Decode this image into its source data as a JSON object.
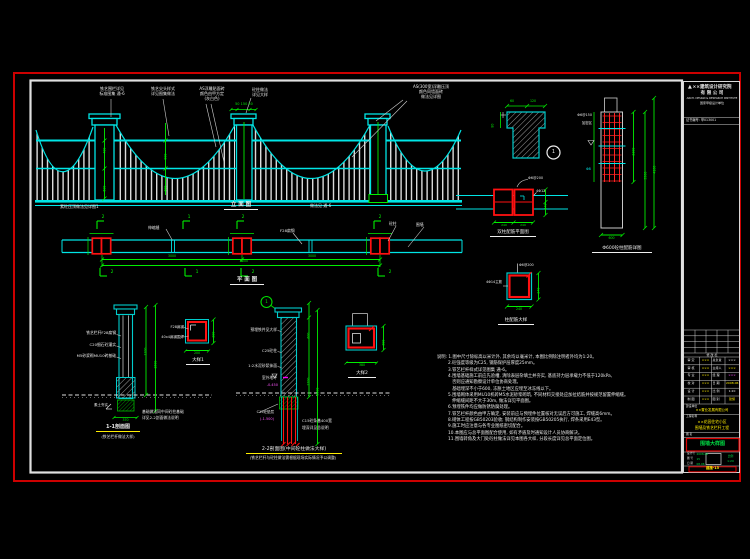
{
  "sheet": {
    "border_color": "#cc0000",
    "frame_color": "#e8e8e8"
  },
  "elevation": {
    "title": "立 面 图",
    "top_labels": [
      {
        "l1": "铁艺围栏详见",
        "l2": "标准图集 通-6"
      },
      {
        "l1": "铁艺尖头样式",
        "l2": "详见图集做法"
      },
      {
        "l1": "AS浮雕贴面砖",
        "l2": "颜色由甲方定",
        "l3": "(灰白色)"
      },
      {
        "l1": "砼柱做法",
        "l2": "详见大样"
      },
      {
        "l1": "AS(300宽)浮雕压顶",
        "l2": "颜色同墙面砖",
        "l3": "做法见详图"
      }
    ],
    "ground_note": "素砼压顶做法见详图1",
    "right_note": "做法见 通-6",
    "dims": {
      "cap": "50 150 50",
      "h1": "400",
      "h2": "600",
      "m1": "900",
      "m2": "300"
    }
  },
  "plan": {
    "title": "平 面 图",
    "joint_note": "伸缩缝",
    "note_mid": "F28扁钢",
    "note_col": "砼柱",
    "note_wall": "围墙",
    "marks_top": [
      "2",
      "1",
      "2",
      "2"
    ],
    "marks_bot": [
      "2",
      "1",
      "2",
      "2"
    ],
    "dims": {
      "d1": "3000",
      "d2": "3000",
      "d3": "6000"
    }
  },
  "section11": {
    "labels": [
      "铁艺栏杆F28扁钢",
      "C20细石砼灌实",
      "M5砂浆砌MU10砖基础"
    ],
    "below": "素土夯实",
    "note1": "基础做法同中间砼柱基础",
    "note2": "详见2-2剖面做法说明",
    "dims": {
      "v1": "1200",
      "v2": "1500",
      "b": "370"
    },
    "title": "1-1剖面图",
    "subtitle": "(铁艺栏杆做法大样)"
  },
  "detail1": {
    "l1": "F28扁钢",
    "l2": "40x4扁钢围焊",
    "dims": {
      "r": "200",
      "b": "200"
    },
    "title": "大样1"
  },
  "section22": {
    "callout": "1",
    "labels": [
      "预埋铁件见大样",
      "C25砼柱",
      "1:2水泥砂浆抹面",
      "室外地坪"
    ],
    "level": "-0.450",
    "below1": "C15砼垫层",
    "below2": "(-1.500)",
    "note1": "C15砼条基400宽",
    "note2": "埋深详见总说明",
    "dims": {
      "v1": "600",
      "v2": "2700",
      "v3": "3300"
    },
    "title": "2-2剖面图(中间砼柱做法大样)",
    "subtitle": "(铁艺栏杆与砼柱做法需根据现场实际情况予以调整)"
  },
  "detail2": {
    "title": "大样2",
    "dims": {
      "b": "380",
      "r": "380"
    }
  },
  "rebar_plan": {
    "title": "双柱配筋平面图",
    "t1": "Φ6@200",
    "t2": "4Φ12",
    "dims": {
      "r": "240",
      "b1": "240",
      "b2": "240"
    }
  },
  "column_elev": {
    "title": "Φ600砼柱配筋详图",
    "l1": "Φ6@150",
    "l2": "加密区",
    "l3": "Φ8",
    "dims": {
      "r1": "2100",
      "r2": "3500",
      "r3": "4100",
      "b": "600"
    }
  },
  "detail3": {
    "title": "柱配筋大样",
    "t1": "Φ6@200",
    "t2": "4Φ14主筋",
    "dims": {
      "r": "240",
      "b": "240"
    }
  },
  "thatch": {
    "num": "1",
    "dims": {
      "a": "60",
      "b": "120",
      "l": "80"
    }
  },
  "notes": {
    "lines": [
      "说明: 1.图中尺寸除标高以米计外, 其余均以毫米计, 本图比例除注明者外均为1:20。",
      "2.砼强度等级为C25, 钢筋保护层厚度25mm。",
      "3.铁艺栏杆样式详见图集 通-6。",
      "4.围墙基础施工前应先验槽, 清除表层杂填土并夯实, 基底持力层承载力不低于120kPa,",
      "   否则应通知勘察设计单位协商处理。",
      "   基础埋深不小于600, 冻胀土地区应埋至冰冻线以下。",
      "5.围墙砌体采用MU10机砖M5水泥砂浆砌筑, 不同材料交接处应加拉结筋并按规范留置伸缩缝。",
      "   伸缩缝间距不大于30m, 做法详见平面图。",
      "6.预埋铁件均应做防锈防腐处理。",
      "7.铁艺栏杆颜色由甲方确定, 安装前应与预埋件位置核对无误后方可施工, 焊缝高6mm。",
      "8.砌体工程按GB50203验收; 钢结构制作安装按GB50205执行, 焊条采用E43型。",
      "9.施工时应注意与各专业图纸密切配合。",
      "10.本图应与总平面图配合使用, 如有矛盾及时通知设计人员协商解决。",
      "11.围墙转角及大门处砼柱做法详见本图各大样, 分段长度详见总平面定位图。"
    ]
  },
  "titleblock": {
    "logo_mark": "▲",
    "name1": "××建筑设计研究院",
    "name2": "有 限 公 司",
    "name_en": "ARCH. DESIGN & RESEARCH INSTITUTE",
    "cert": "国家甲级设计单位",
    "license": "证书编号: 甲013001",
    "rev_header": "修 改 栏",
    "sign_rows": [
      {
        "l": "审 定",
        "lv": "×××",
        "r": "总负责",
        "rv": "×××"
      },
      {
        "l": "审 核",
        "lv": "×××",
        "r": "主持人",
        "rv": "×××"
      },
      {
        "l": "专 业",
        "lv": "×××",
        "r": "经 理",
        "rv": "×××"
      },
      {
        "l": "校 对",
        "lv": "×××",
        "r": "日 期",
        "rv": "2008.06"
      },
      {
        "l": "设 计",
        "lv": "×××",
        "r": "比 例",
        "rv": "1:20"
      },
      {
        "l": "制 图",
        "lv": "×××",
        "r": "图 别",
        "rv": "建施"
      }
    ],
    "owner_label": "建设单位",
    "owner": "××置业发展有限公司",
    "project_label": "工程名称",
    "project1": "××花园住宅小区",
    "project2": "围墙及铁艺栏杆工程",
    "name_label": "图 名",
    "drawing_name": "围墙大样图",
    "tbl": {
      "l1": "设计号",
      "v1": "2008-06",
      "l2": "图 号",
      "v2": "15",
      "l3": "日 期",
      "v3": "08.06",
      "scale_label": "比例",
      "scale": "1:20"
    },
    "sheet_no": "建施-15"
  }
}
